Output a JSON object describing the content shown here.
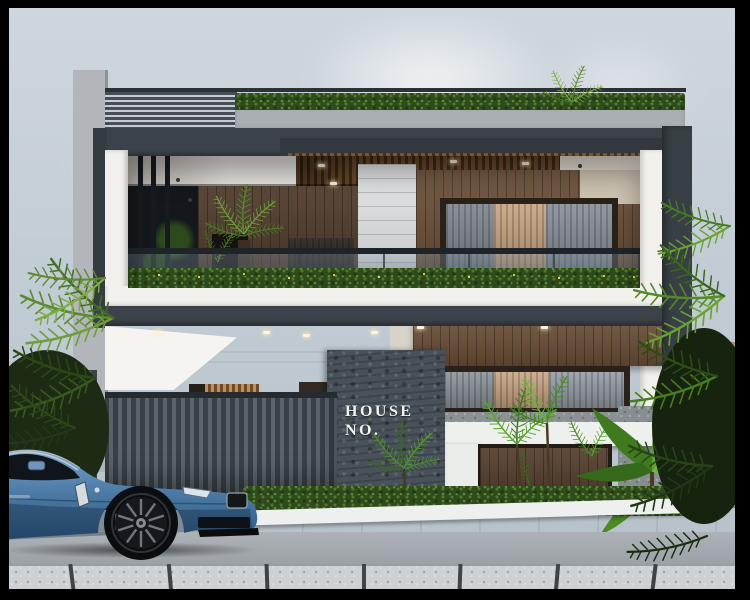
{
  "scene": {
    "description": "3D architectural render of a modern two-storey house with rooftop hedge, louvered parapet, glass balcony, wood paneling, slatted gate, tropical plants and a blue coupe parked on the street",
    "sign": {
      "line1": "HOUSE",
      "line2": "NO."
    },
    "colors": {
      "sky_top": "#cfd7de",
      "sky_bot": "#b5bfc8",
      "facade_dark": "#3b4249",
      "facade_white": "#f1f0ed",
      "wood_light": "#6b4f38",
      "wood_dark": "#4e3a2a",
      "stone_parapet": "#a9afb3",
      "slate": "#49525a",
      "gate_a": "#5b646c",
      "gate_b": "#394147",
      "hedge": "#2f4a1d",
      "leaf": "#4e7a28",
      "car": "#46759f",
      "road": "#989ea4",
      "walk": "#cbd1d5",
      "wall_tan": "#a29180",
      "curtain_tan": "#c6a37f",
      "curtain_gray": "#7d848e",
      "sign": "#f2f2f2"
    }
  }
}
